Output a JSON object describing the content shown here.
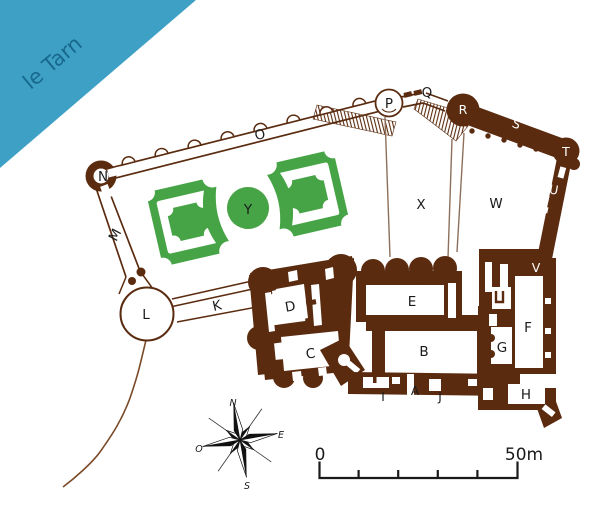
{
  "title": "castle-plan-le-tarn",
  "colors": {
    "wall_brown": "#5a2b0f",
    "fence_brown": "#8c705c",
    "path_brown": "#7a4a28",
    "garden_green": "#46a446",
    "river_blue": "#3fa0c6",
    "river_text": "#17698e",
    "label": "#1a1a1a",
    "label_on_wall": "#ffffff",
    "compass_black": "#111111",
    "background": "#ffffff"
  },
  "river": {
    "label": "le Tarn"
  },
  "compass": {
    "north": "N",
    "east": "E",
    "south": "S",
    "west": "O"
  },
  "scale_bar": {
    "start_label": "0",
    "end_label": "50m",
    "segments": 5
  },
  "map_labels": [
    {
      "id": "le-tarn",
      "text": "le Tarn",
      "x": 57,
      "y": 68,
      "size": 21,
      "color": "#17698e",
      "rot": -40
    },
    {
      "id": "N",
      "text": "N",
      "x": 103,
      "y": 181
    },
    {
      "id": "M",
      "text": "M",
      "x": 119,
      "y": 237,
      "rot": -62
    },
    {
      "id": "O",
      "text": "O",
      "x": 261,
      "y": 139,
      "rot": -14
    },
    {
      "id": "P",
      "text": "P",
      "x": 389,
      "y": 108
    },
    {
      "id": "Q",
      "text": "Q",
      "x": 427,
      "y": 97
    },
    {
      "id": "R",
      "text": "R",
      "x": 463,
      "y": 114,
      "color": "#ffffff",
      "size": 12.5
    },
    {
      "id": "S",
      "text": "S",
      "x": 515,
      "y": 128,
      "color": "#ffffff",
      "size": 12.5,
      "rot": 20
    },
    {
      "id": "T",
      "text": "T",
      "x": 566,
      "y": 156,
      "color": "#ffffff",
      "size": 12.5
    },
    {
      "id": "U",
      "text": "U",
      "x": 553,
      "y": 194,
      "color": "#ffffff",
      "size": 12.5,
      "rot": 10
    },
    {
      "id": "V",
      "text": "V",
      "x": 536,
      "y": 272,
      "color": "#ffffff",
      "size": 12.5
    },
    {
      "id": "W",
      "text": "W",
      "x": 496,
      "y": 208
    },
    {
      "id": "X",
      "text": "X",
      "x": 421,
      "y": 209
    },
    {
      "id": "Y",
      "text": "Y",
      "x": 248,
      "y": 214
    },
    {
      "id": "K",
      "text": "K",
      "x": 218,
      "y": 310,
      "rot": -13
    },
    {
      "id": "L",
      "text": "L",
      "x": 146,
      "y": 319
    },
    {
      "id": "D",
      "text": "D",
      "x": 291,
      "y": 311,
      "rot": -10
    },
    {
      "id": "C",
      "text": "C",
      "x": 311,
      "y": 358,
      "rot": -7
    },
    {
      "id": "E",
      "text": "E",
      "x": 412,
      "y": 306
    },
    {
      "id": "B",
      "text": "B",
      "x": 424,
      "y": 356
    },
    {
      "id": "F",
      "text": "F",
      "x": 528,
      "y": 332
    },
    {
      "id": "G",
      "text": "G",
      "x": 502,
      "y": 352
    },
    {
      "id": "H",
      "text": "H",
      "x": 526,
      "y": 399
    },
    {
      "id": "I",
      "text": "I",
      "x": 383,
      "y": 401,
      "size": 12
    },
    {
      "id": "A",
      "text": "A",
      "x": 415,
      "y": 395,
      "size": 12
    },
    {
      "id": "J",
      "text": "J",
      "x": 440,
      "y": 401,
      "size": 12
    },
    {
      "id": "compass-n",
      "text": "N",
      "x": 233,
      "y": 406,
      "size": 9.5,
      "font": "serif-italic"
    },
    {
      "id": "compass-e",
      "text": "E",
      "x": 281,
      "y": 438,
      "size": 9.5,
      "font": "serif-italic"
    },
    {
      "id": "compass-s",
      "text": "S",
      "x": 247,
      "y": 489,
      "size": 9.5,
      "font": "serif-italic"
    },
    {
      "id": "compass-o",
      "text": "O",
      "x": 199,
      "y": 452,
      "size": 9.5,
      "font": "serif-italic"
    },
    {
      "id": "scale-0",
      "text": "0",
      "x": 320,
      "y": 460,
      "size": 17
    },
    {
      "id": "scale-50m",
      "text": "50m",
      "x": 524,
      "y": 460,
      "size": 17
    }
  ]
}
